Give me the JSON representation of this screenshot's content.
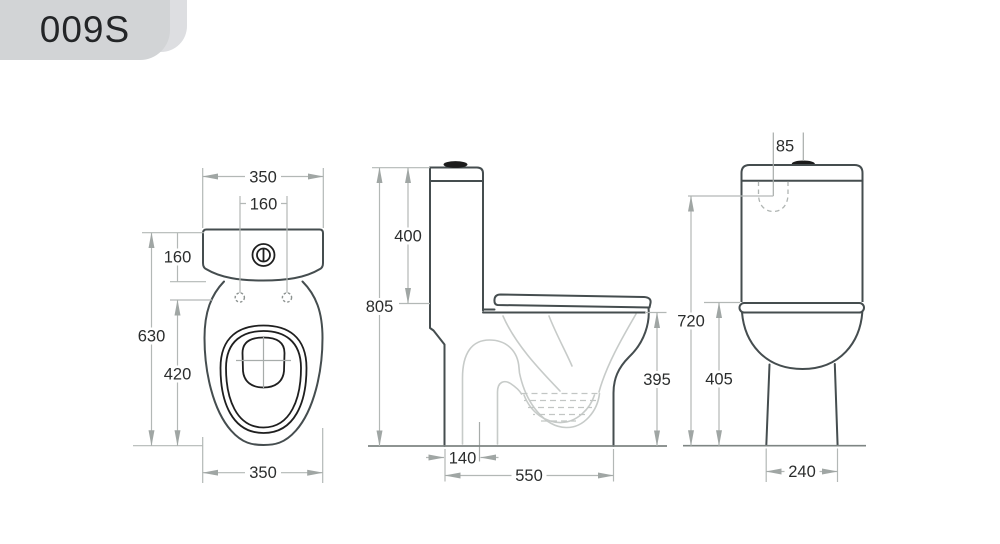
{
  "badge": {
    "label": "009S"
  },
  "colors": {
    "canvas_bg": "#ffffff",
    "outline": "#454d4f",
    "detail_dark": "#1f1f1f",
    "dim_line": "#b3b8b6",
    "dim_arrow": "#a0a6a4",
    "dim_text": "#2b2d2d",
    "inner_line": "#c7cbc9",
    "floor_line": "#7e8583",
    "badge_bg": "#d2d4d6",
    "badge_bg_back": "#dddee1",
    "badge_text": "#232527",
    "button_fill": "#1b1b1b"
  },
  "views": {
    "top": {
      "dims": {
        "tank_width": "350",
        "hole_spacing": "160",
        "tank_depth": "160",
        "overall_length": "630",
        "bowl_length": "420",
        "bowl_width": "350"
      }
    },
    "side": {
      "dims": {
        "tank_height": "400",
        "overall_height": "805",
        "rim_height": "395",
        "trap_setout": "140",
        "overall_depth": "550"
      }
    },
    "front": {
      "dims": {
        "inlet_offset": "85",
        "inlet_height": "720",
        "bowl_height": "405",
        "base_width": "240"
      }
    }
  }
}
